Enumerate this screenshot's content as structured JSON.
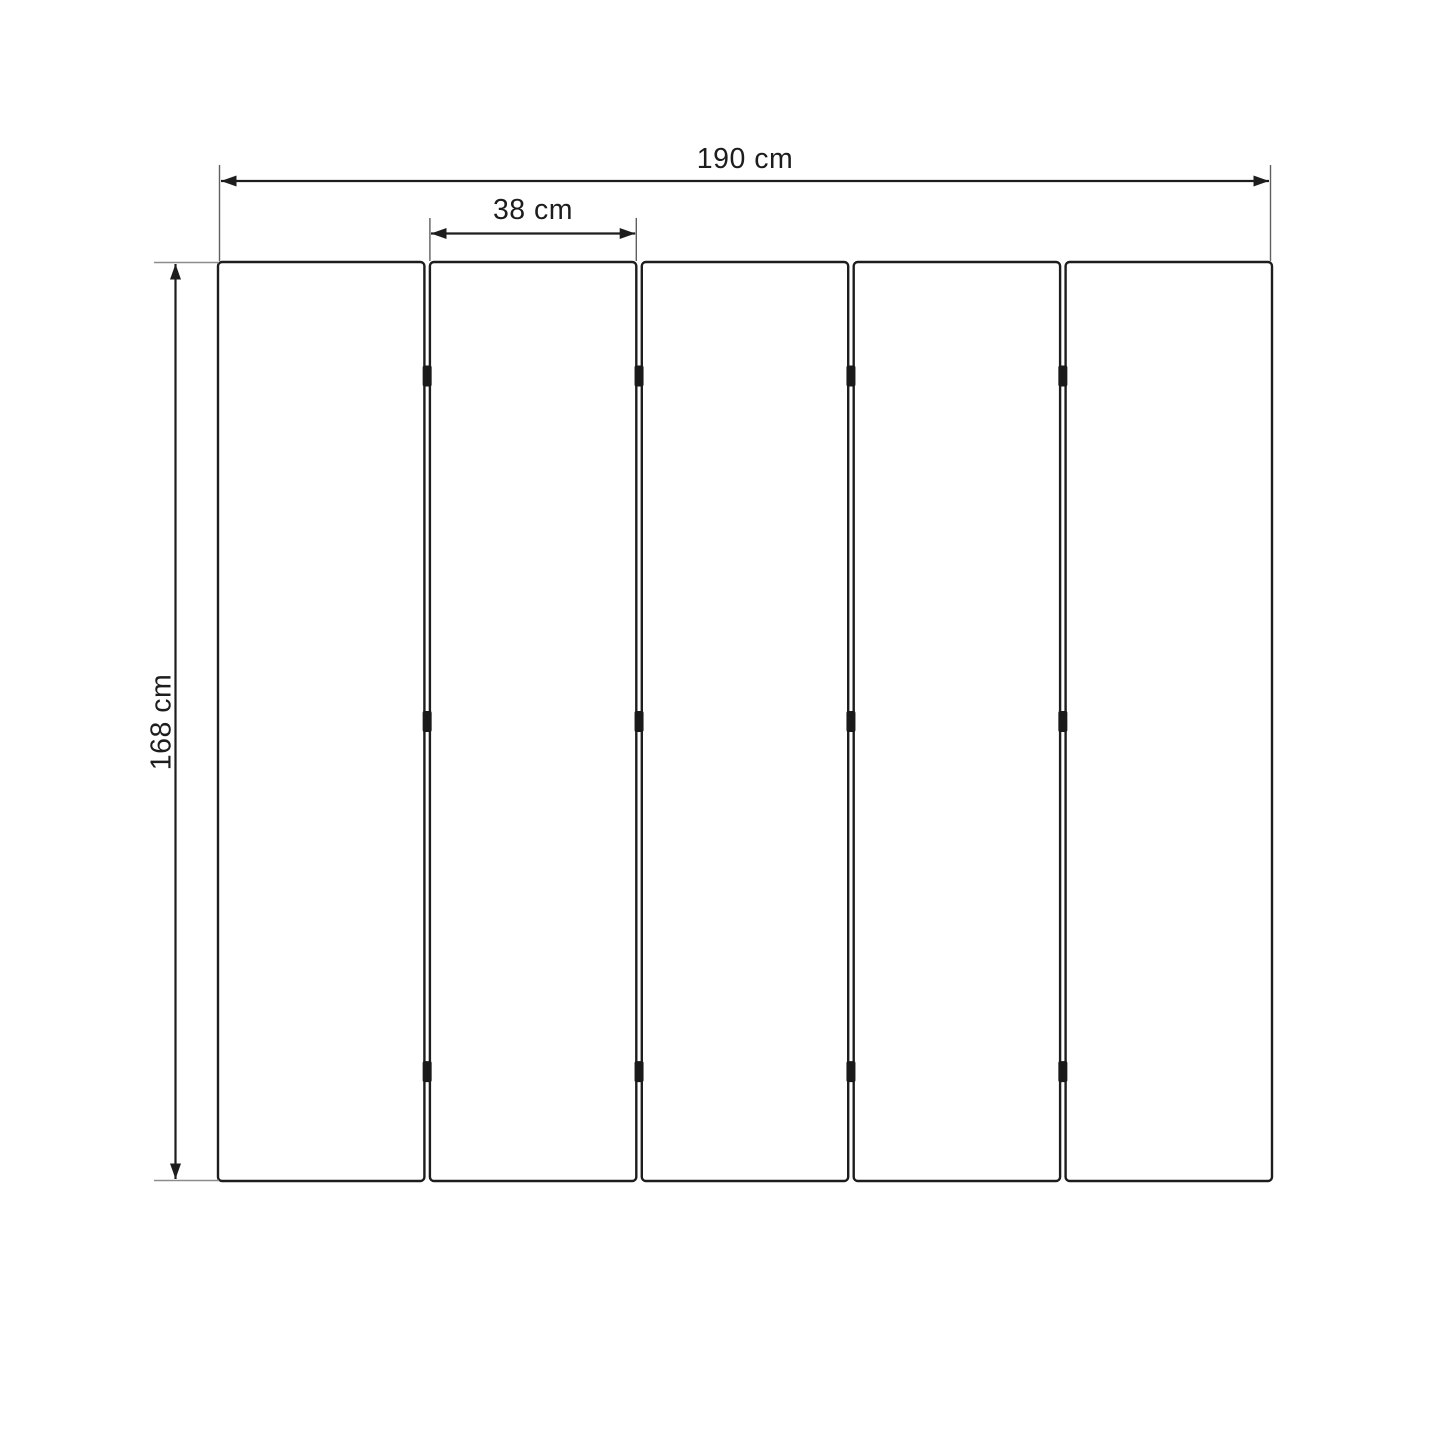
{
  "diagram": {
    "type": "product-dimension-diagram",
    "subject": "five-panel folding screen (front view)",
    "dimension_labels": {
      "total_width": "190 cm",
      "single_panel_width": "38 cm",
      "height": "168 cm"
    },
    "panels": {
      "count": 5,
      "hinge_rows_per_gap": 3
    },
    "colors": {
      "line": "#1d1d1d",
      "extension_line": "#5f5f5f",
      "extension_line_gray": "#8c8c8c",
      "hinge": "#1a1a1a",
      "panel_fill": "#ffffff",
      "background": "#ffffff"
    }
  }
}
